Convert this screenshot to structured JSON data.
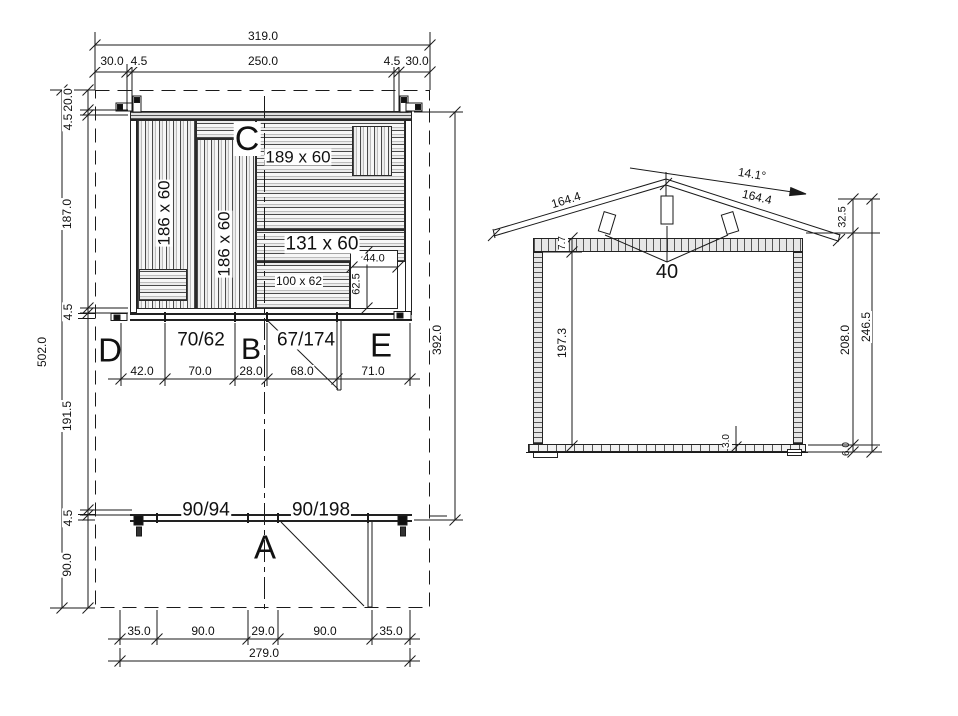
{
  "plan": {
    "room_labels": {
      "a": "A",
      "b": "B",
      "c": "C",
      "d": "D",
      "e": "E"
    },
    "panel_labels": {
      "left_board": "186 x 60",
      "mid_board": "186 x 60",
      "top_board": "189 x 60",
      "right_board": "131 x 60",
      "small_board": "100 x 62"
    },
    "opening_labels": {
      "front_window": "70/62",
      "front_door": "67/174",
      "porch_window": "90/94",
      "porch_door": "90/198"
    },
    "dims": {
      "total_width": "319.0",
      "top_chain": [
        "30.0",
        "4.5",
        "250.0",
        "4.5",
        "30.0"
      ],
      "total_height": "502.0",
      "left_chain": [
        "20.0",
        "4.5",
        "187.0",
        "4.5",
        "191.5",
        "4.5",
        "90.0"
      ],
      "right_height": "392.0",
      "mid_chain": [
        "42.0",
        "70.0",
        "28.0",
        "68.0",
        "71.0"
      ],
      "bottom_chain": [
        "35.0",
        "90.0",
        "29.0",
        "90.0",
        "35.0"
      ],
      "bottom_total": "279.0",
      "notch_width": "44.0",
      "notch_depth": "62.5"
    }
  },
  "elevation": {
    "dims": {
      "roof_angle": "14.1°",
      "slope_left": "164.4",
      "slope_right": "164.4",
      "roof_rise": "32.5",
      "beam_height": "7.7",
      "interior_height": "197.3",
      "wall_height": "208.0",
      "total_height": "246.5",
      "floor_height": "6.0",
      "deck_thickness": "3.0",
      "purlin_size": "40"
    }
  },
  "colors": {
    "line": "#1a1a1a",
    "background": "#ffffff"
  }
}
